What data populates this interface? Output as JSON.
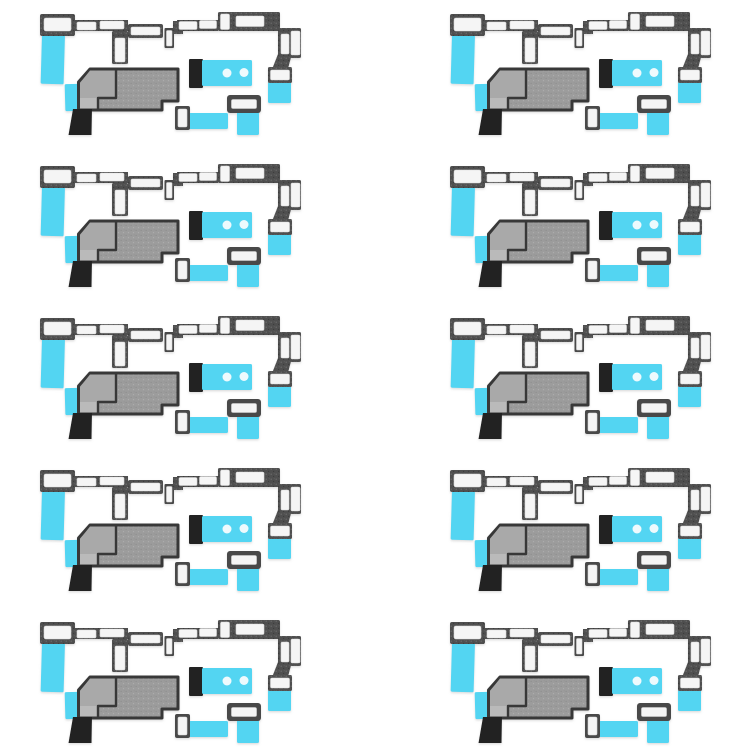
{
  "canvas": {
    "width": 750,
    "height": 750,
    "background": "#ffffff"
  },
  "grid": {
    "rows": 5,
    "cols": 2,
    "set_count": 10,
    "x_positions": [
      40,
      450
    ],
    "y_positions": [
      12,
      164,
      316,
      468,
      620
    ]
  },
  "colors": {
    "bg": "#ffffff",
    "dark": "#4f4f4f",
    "dark_solid": "#4a4a4a",
    "dark_speck_light": "#6e6e6e",
    "dark_speck_dark": "#3a3a3a",
    "slot": "#f5f5f5",
    "slot_edge": "#d9d9d9",
    "cyan": "#53d5f2",
    "cyan_deep": "#3fc9ee",
    "mesh": "#9c9c9c",
    "mesh_speck_light": "#adadad",
    "mesh_speck_dark": "#8a8a8a",
    "mesh_light": "#a9a9a9",
    "mesh_lighter": "#bababa",
    "mesh_outline": "#373737",
    "black": "#222222",
    "dot": "#eefafd",
    "shadow": "#bdbdbd"
  },
  "pieces": [
    {
      "id": "top-left-bracket-sticker",
      "parts": [
        "dark-adhesive-bracket",
        "white-slots",
        "cyan-film-tail"
      ]
    },
    {
      "id": "top-right-bracket-sticker",
      "parts": [
        "dark-adhesive-bracket",
        "white-slots",
        "white-side-tab",
        "cyan-film-tail"
      ]
    },
    {
      "id": "speaker-mesh-sticker",
      "parts": [
        "gray-mesh-pad",
        "light-inner-region",
        "black-corner-block",
        "cyan-film-strip"
      ]
    },
    {
      "id": "speaker-adhesive-sticker",
      "parts": [
        "black-end-block",
        "cyan-pad",
        "two-white-holes"
      ]
    },
    {
      "id": "frame-adhesive-sticker",
      "parts": [
        "dark-frame",
        "white-center",
        "cyan-film-tail"
      ]
    },
    {
      "id": "tab-adhesive-sticker",
      "parts": [
        "dark-bordered-white-tab",
        "cyan-film-strip"
      ]
    }
  ]
}
